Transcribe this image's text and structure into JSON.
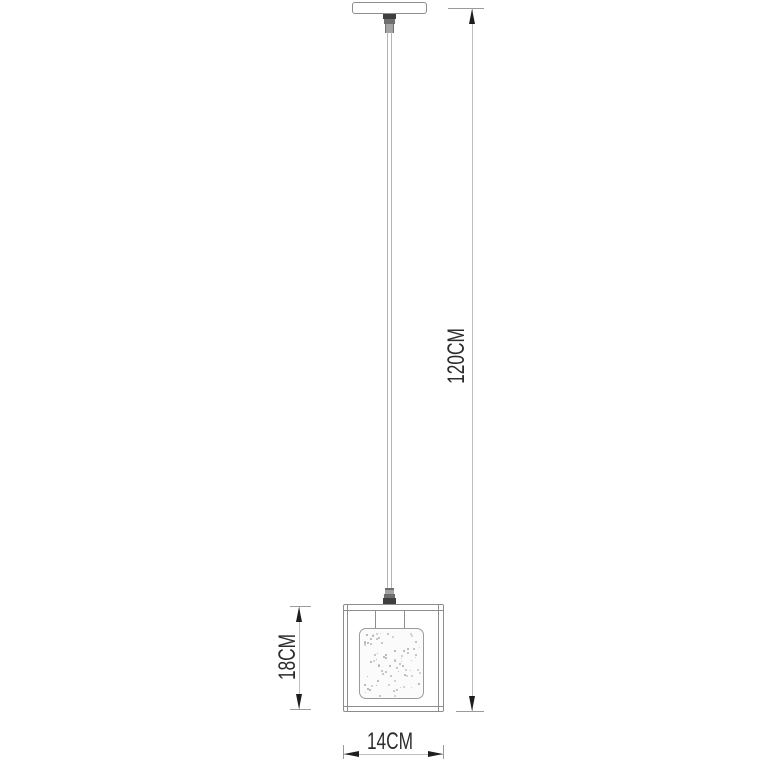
{
  "dimensions": {
    "overall_drop": {
      "label": "120CM",
      "orientation": "vertical"
    },
    "shade_height": {
      "label": "18CM",
      "orientation": "vertical"
    },
    "shade_width": {
      "label": "14CM",
      "orientation": "horizontal"
    }
  },
  "colors": {
    "background": "#ffffff",
    "outline": "#8d8d8d",
    "cord": "#b4b4b4",
    "dimension_line": "#c0c0c0",
    "tick": "#9b9b9b",
    "arrow": "#1e1e1e",
    "text": "#2c2c2c",
    "fitting_dark": "#3f3f3f",
    "fitting_mid": "#6e6e6e",
    "fitting_light": "#a3a3a3",
    "glass_fill": "#fbfbfb",
    "speckle": "#b5b5b5"
  }
}
